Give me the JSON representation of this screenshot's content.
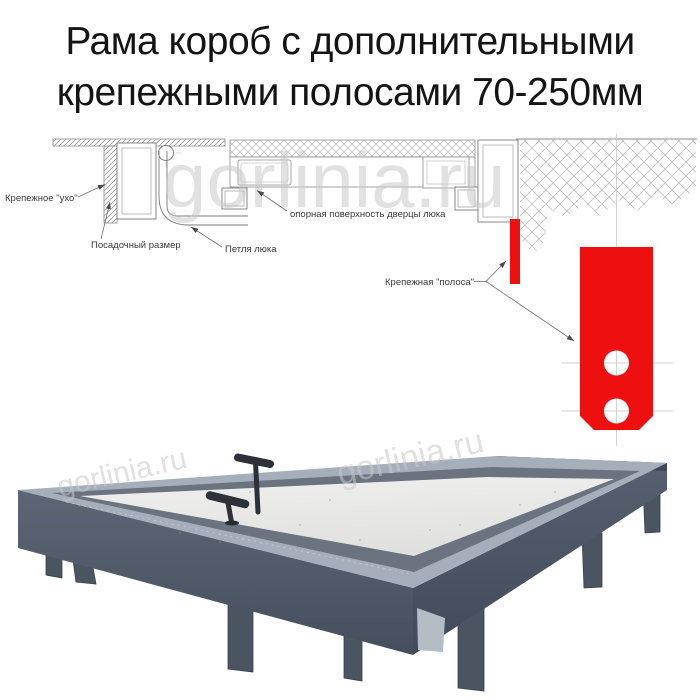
{
  "title": {
    "line1": "Рама короб с дополнительными",
    "line2": "крепежными полосами 70-250мм"
  },
  "watermark": {
    "text": "gorlinia.ru"
  },
  "diagram": {
    "labels": {
      "ear": "Крепежное \"ухо\"",
      "seat": "Посадочный размер",
      "hinge": "Петля люка",
      "support": "опорная поверхность дверцы люка",
      "strip": "Крепежная \"полоса\""
    },
    "colors": {
      "strip_red": "#ee1010",
      "line": "#7a7a7a",
      "hatch": "#b5b5b5",
      "centerline": "#c9c9c9",
      "label_text": "#3a3a3a"
    }
  },
  "photo": {
    "colors": {
      "frame_dark": "#4e5765",
      "rim_light": "#a6aebb",
      "inner_strip": "#6b7380",
      "panel": "#e9eae7",
      "handle": "#2d3239",
      "leg": "#4b5461"
    }
  }
}
